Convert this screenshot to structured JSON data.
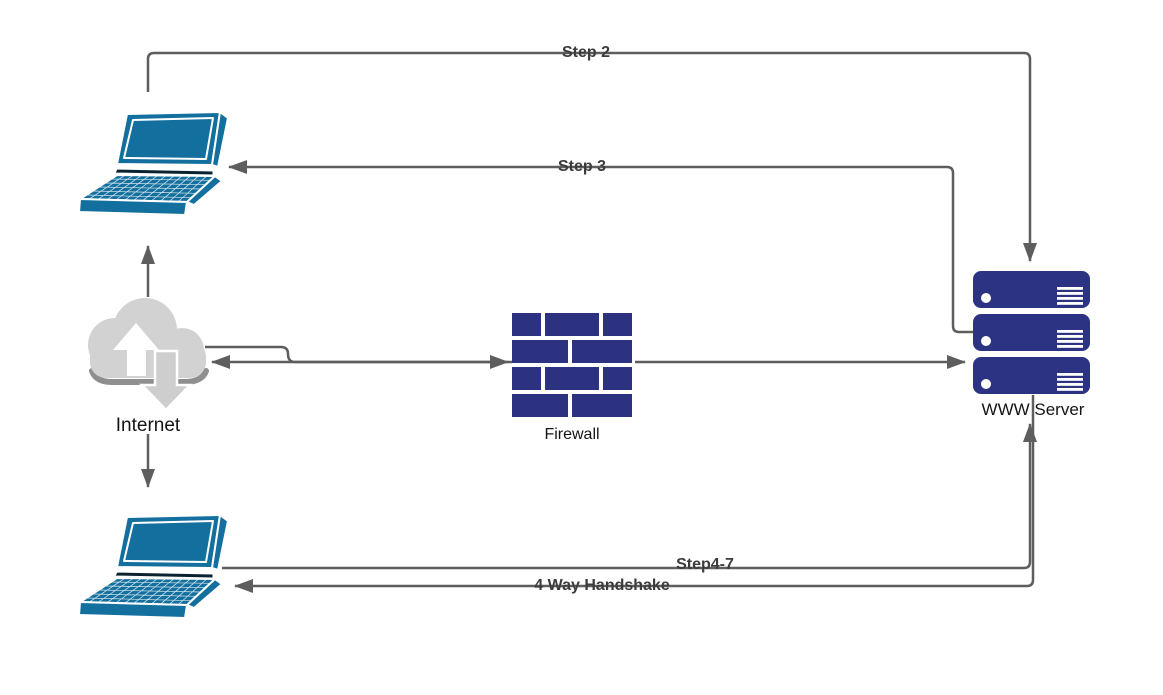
{
  "diagram": {
    "type": "network-flow-diagram",
    "background": "#ffffff",
    "nodes": {
      "client_top": {
        "icon": "laptop-icon"
      },
      "internet": {
        "label": "Internet",
        "icon": "cloud-upload-download-icon"
      },
      "firewall": {
        "label": "Firewall",
        "icon": "brick-wall-icon"
      },
      "www_server": {
        "label": "WWW Server",
        "icon": "server-stack-icon",
        "units": 3
      },
      "client_bottom": {
        "icon": "laptop-icon"
      }
    },
    "edge_labels": {
      "step2": "Step 2",
      "step3": "Step 3",
      "step4_7": "Step4-7",
      "handshake": "4 Way Handshake"
    },
    "colors": {
      "laptop_blue": "#136f9e",
      "brick_navy": "#2c3180",
      "server_navy": "#2d3383",
      "connector_gray": "#5e5e5e",
      "cloud_gray": "#d2d2d2",
      "cloud_shadow": "#8f8f8f",
      "edge_label_text": "#3c3c3c",
      "node_label_text": "#141414"
    }
  }
}
